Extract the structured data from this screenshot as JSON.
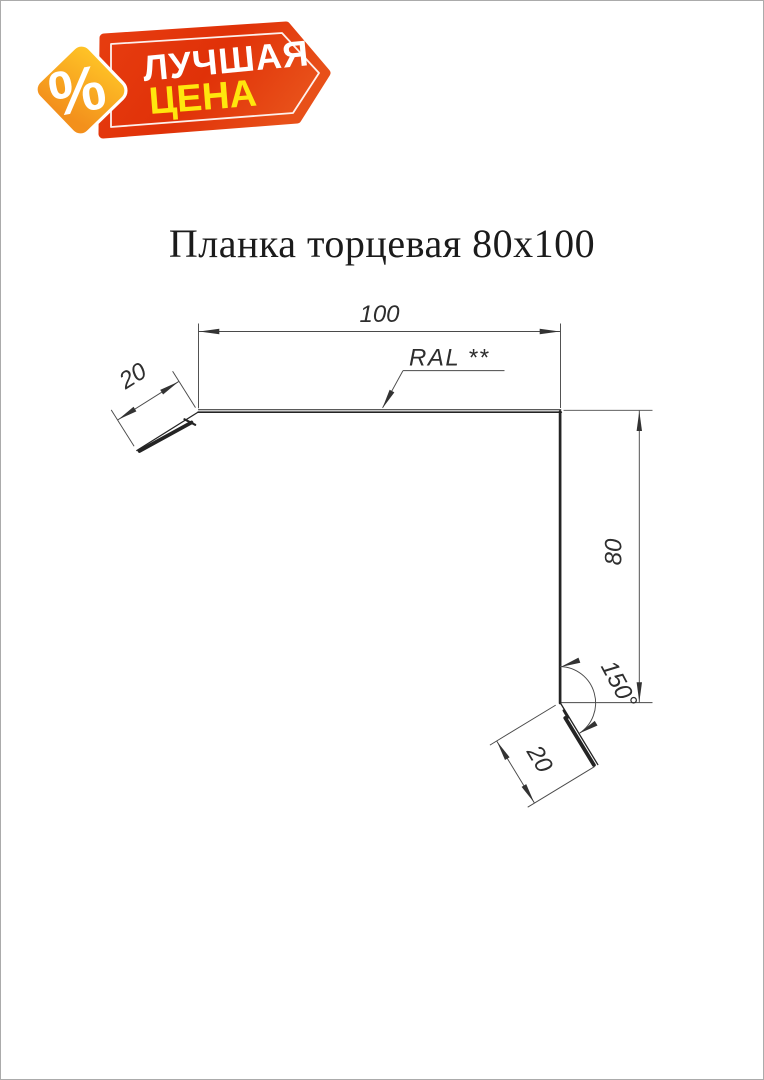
{
  "badge": {
    "percent": "%",
    "line1": "ЛУЧШАЯ",
    "line2": "ЦЕНА",
    "colors": {
      "banner_red": "#e23408",
      "banner_red_light": "#ea4d1a",
      "diamond_top": "#ffc627",
      "diamond_bottom": "#f3901c",
      "line1_color": "#ffffff",
      "line2_color": "#ffe60d"
    }
  },
  "title": "Планка торцевая 80x100",
  "drawing": {
    "width_label": "100",
    "height_label": "80",
    "left_flange_label": "20",
    "bottom_flange_label": "20",
    "angle_label": "150°",
    "coating_label": "RAL **",
    "line_color": "#2e2e2e"
  }
}
